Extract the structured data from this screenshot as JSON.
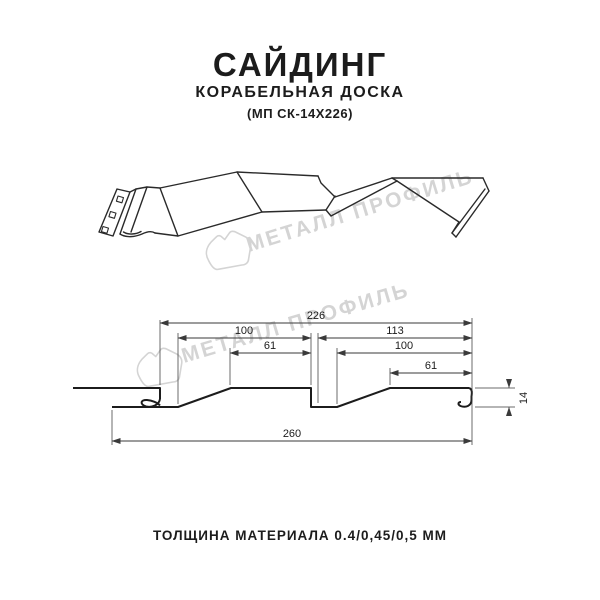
{
  "colors": {
    "ink": "#1c1c1c",
    "sketch": "#2a2a2a",
    "dimline": "#3a3a3a",
    "watermark": "#d4d4d4",
    "bg": "#ffffff"
  },
  "header": {
    "title": "САЙДИНГ",
    "subtitle": "КОРАБЕЛЬНАЯ ДОСКА",
    "model": "(МП СК-14Х226)"
  },
  "watermark": {
    "text": "МЕТАЛЛ ПРОФИЛЬ"
  },
  "dimensions": {
    "total_coverage": "226",
    "left_module": "100",
    "right_module": "113",
    "left_flat": "61",
    "right_module_inner": "100",
    "right_flat": "61",
    "overall_width": "260",
    "profile_height": "14"
  },
  "footer": {
    "thickness": "ТОЛЩИНА МАТЕРИАЛА 0.4/0,45/0,5 ММ"
  }
}
